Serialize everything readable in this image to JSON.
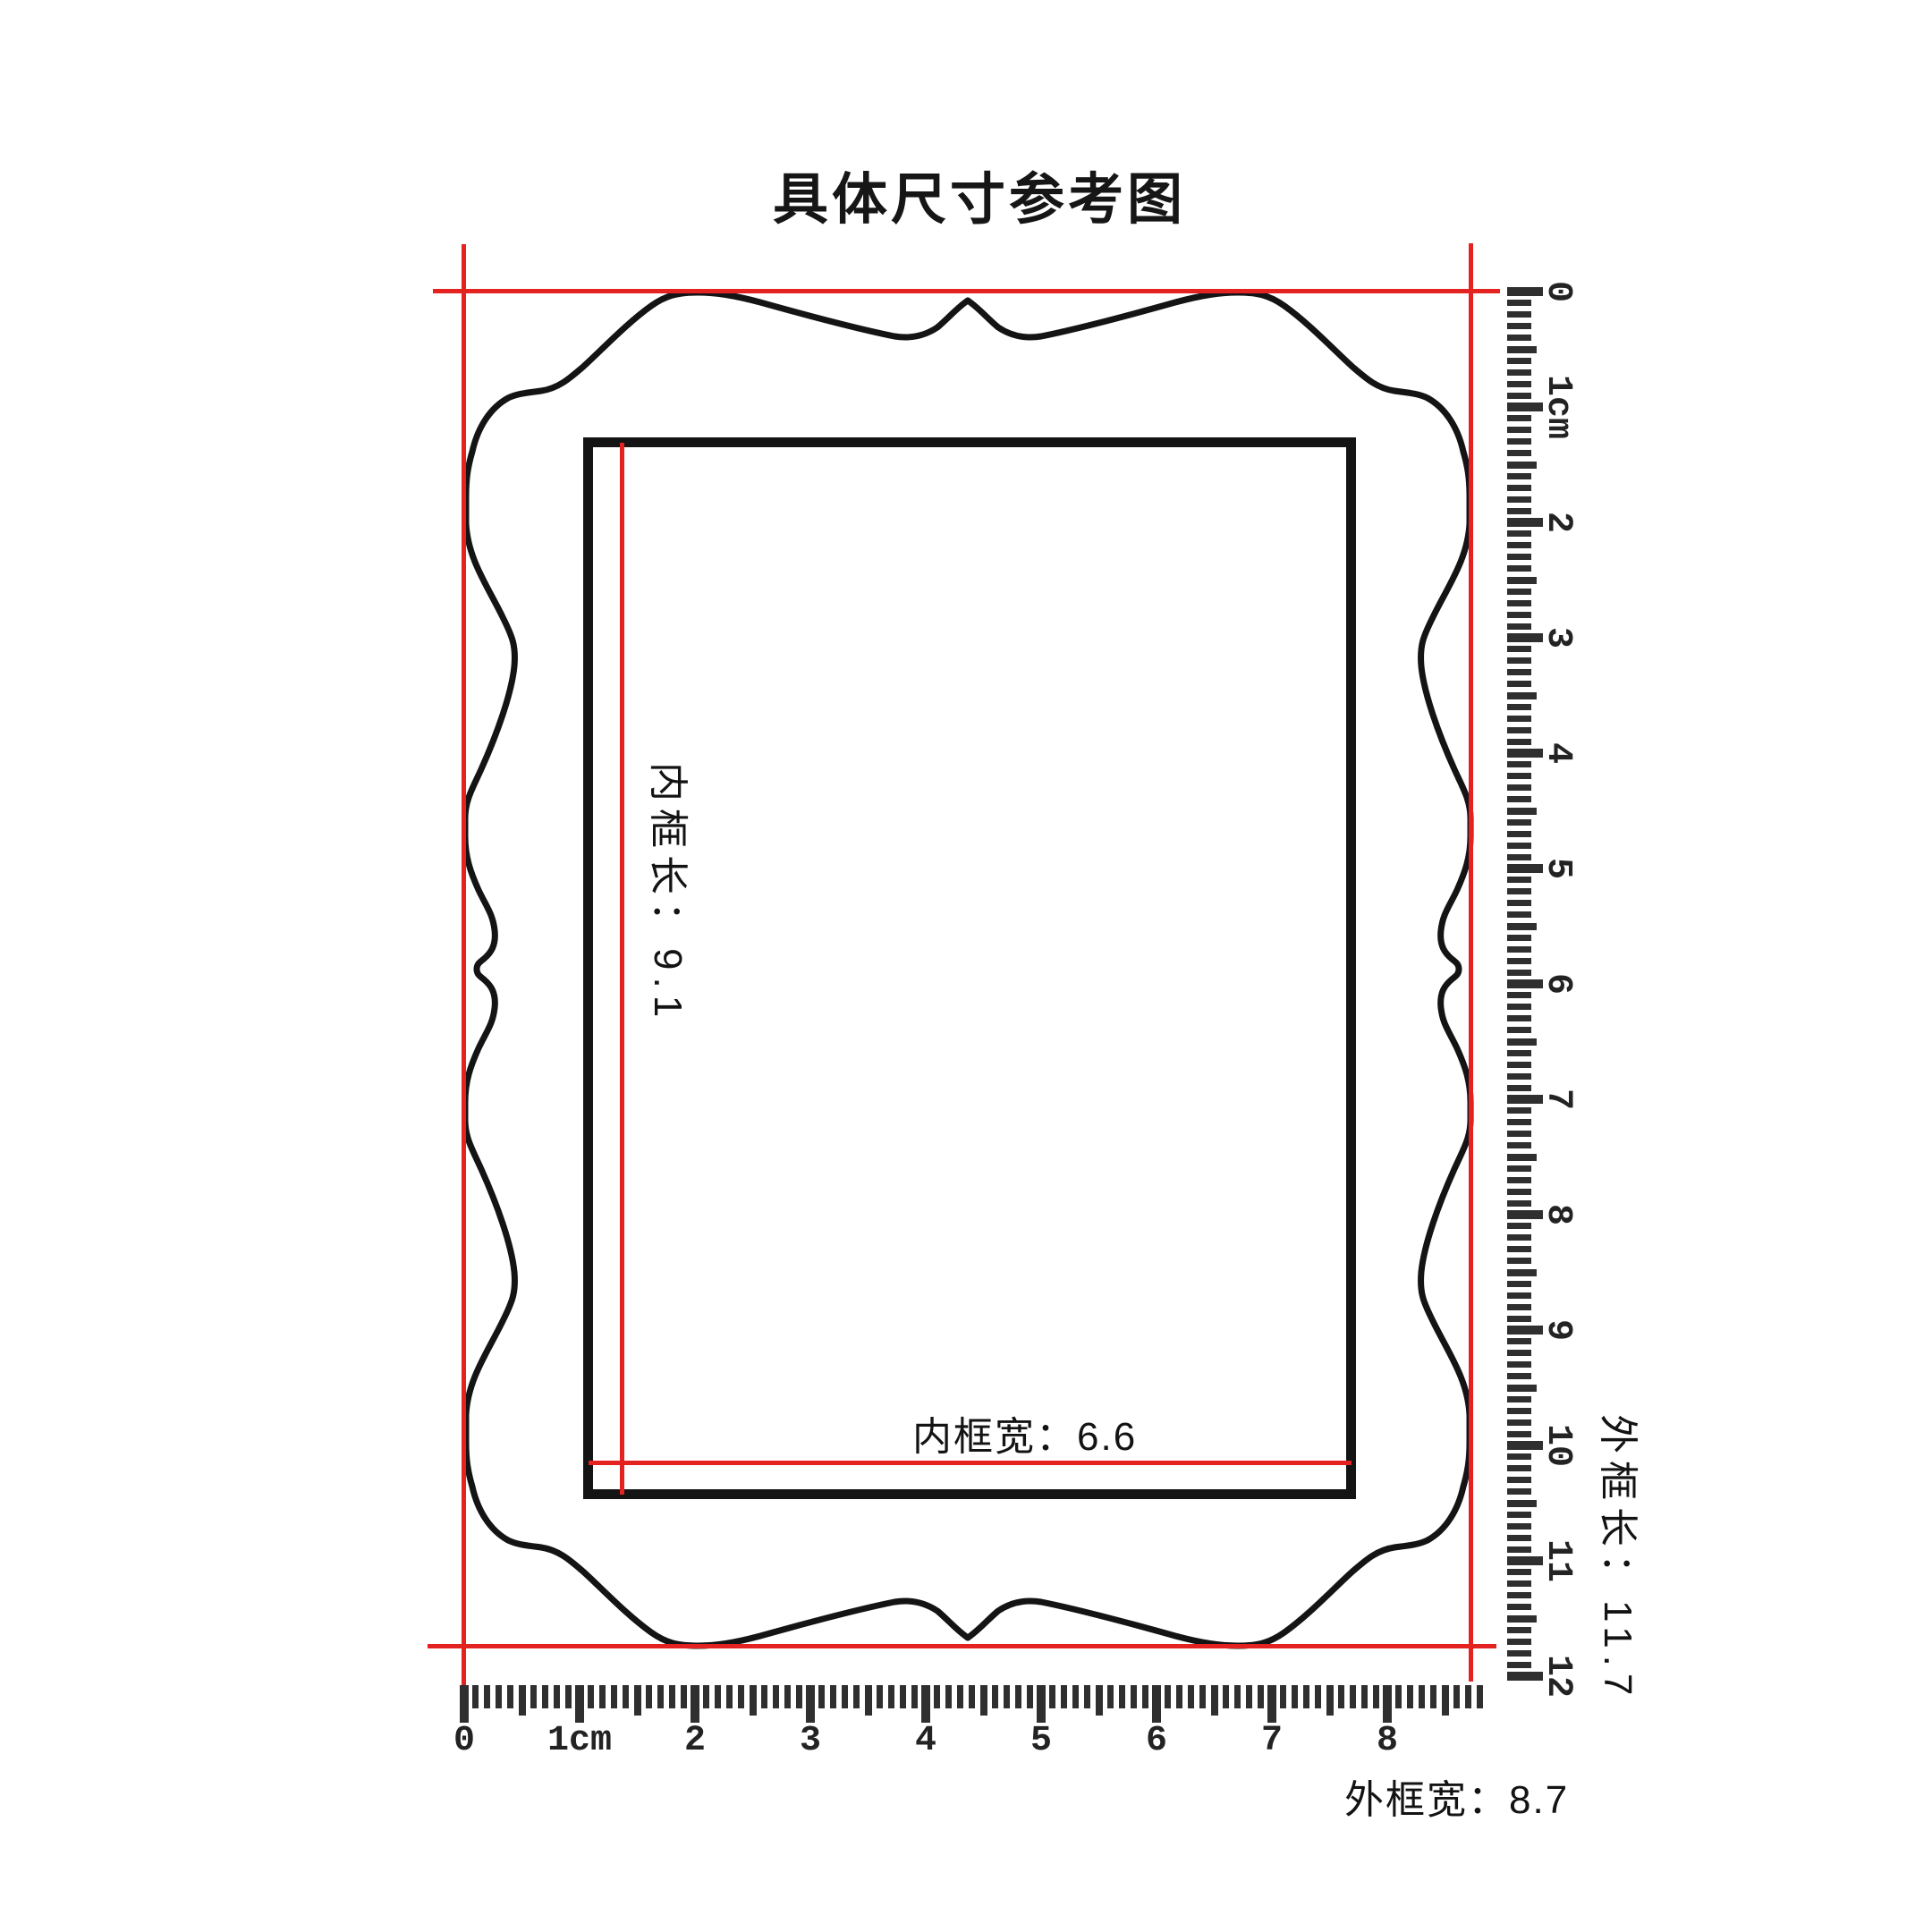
{
  "title": "具体尺寸参考图",
  "frame": {
    "inner_length_label": "内框长：9.1",
    "inner_width_label": "内框宽：6.6",
    "outer_length_label": "外框长：11.7",
    "outer_width_label": "外框宽：8.7"
  },
  "rulers": {
    "bottom": {
      "labels": [
        "0",
        "1cm",
        "2",
        "3",
        "4",
        "5",
        "6",
        "7",
        "8"
      ]
    },
    "right": {
      "labels": [
        "0",
        "1cm",
        "2",
        "3",
        "4",
        "5",
        "6",
        "7",
        "8",
        "9",
        "10",
        "11",
        "12"
      ]
    }
  },
  "colors": {
    "accent_red": "#e42320",
    "line_black": "#141414",
    "tick_gray": "#2f2f2f"
  }
}
